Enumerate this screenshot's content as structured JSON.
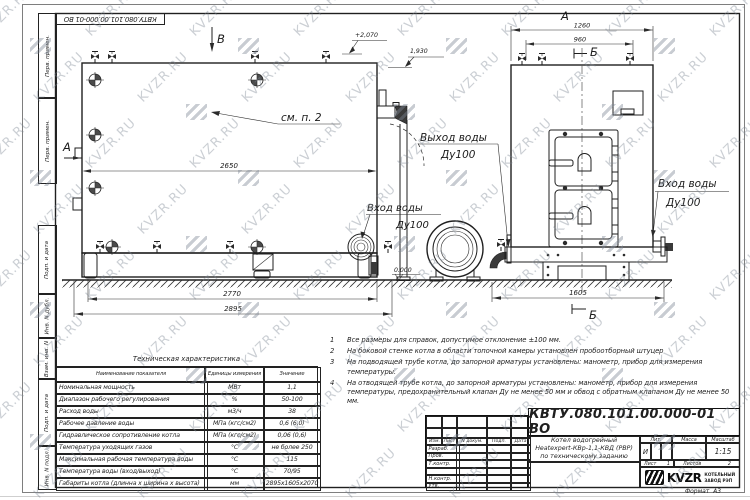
{
  "watermark": {
    "text": "KVZR.RU"
  },
  "corner_stamp": {
    "doc_number": "КВТУ.080.101.00.000-01 ВО"
  },
  "side_strip": {
    "labels": [
      "Перв. примен.",
      "Перв. примен.",
      "Подп. и дата",
      "Инв. N дубл.",
      "Взам. инв. N",
      "Подп. и дата",
      "Инв. N подл."
    ]
  },
  "views": {
    "left": {
      "label_a": "А",
      "label_b": "В",
      "see_note": "см. п. 2",
      "outlet_label": "Выход воды",
      "outlet_dn": "Ду100",
      "inlet_label": "Вход воды",
      "inlet_dn": "Ду100",
      "dim_2650": "2650",
      "dim_2770": "2770",
      "dim_2895": "2895",
      "elev_top": "+2,070",
      "elev_mid": "1,930",
      "elev_zero": "0.000"
    },
    "front": {
      "label_a": "А",
      "sec_b_top": "Б",
      "sec_b_bottom": "Б",
      "inlet_label": "Вход воды",
      "inlet_dn": "Ду100",
      "dim_1260": "1260",
      "dim_960": "960",
      "dim_1605": "1605"
    }
  },
  "notes": [
    {
      "num": "1",
      "text": "Все размеры для справок, допустимое отклонение ±100 мм."
    },
    {
      "num": "2",
      "text": "На боковой стенке котла в области топочной камеры установлен пробоотборный штуцер"
    },
    {
      "num": "3",
      "text": "На  подводящей трубе котла, до запорной арматуры установлены: манометр, прибор для измерения температуры."
    },
    {
      "num": "4",
      "text": "На отводящей трубе котла, до запорной арматуры установлены: манометр, прибор для измерения температуры, предохранительный клапан Ду не менее 50 мм и обвод с обратным клапаном Ду не менее 50 мм."
    }
  ],
  "spec_table": {
    "title": "Техническая характеристика",
    "headers": [
      "Наименование показателя",
      "Единицы измерения",
      "Значение"
    ],
    "rows": [
      [
        "Номинальная мощность",
        "МВт",
        "1,1"
      ],
      [
        "Диапазон рабочего регулирования",
        "%",
        "50-100"
      ],
      [
        "Расход воды",
        "м3/ч",
        "38"
      ],
      [
        "Рабочее давление воды",
        "МПа (кгс/см2)",
        "0,6 (6,0)"
      ],
      [
        "Гидравлическое сопротивление котла",
        "МПа (кгс/см2)",
        "0,06 (0,6)"
      ],
      [
        "Температура уходящих газов",
        "°С",
        "не более 250"
      ],
      [
        "Максимальная рабочая температура воды",
        "°С",
        "115"
      ],
      [
        "Температура воды (вход/выход)",
        "°С",
        "70/95"
      ],
      [
        "Габариты котла (длинна х ширина х высота)",
        "мм",
        "2895х1605х2070"
      ]
    ]
  },
  "title_block": {
    "doc_number": "КВТУ.080.101.00.000-01 ВО",
    "header_cells": [
      "Изм.",
      "Лист",
      "N докум.",
      "Подп.",
      "Дата"
    ],
    "left_rows": [
      "Разраб.",
      "Пров.",
      "Т.контр.",
      "",
      "Н.контр.",
      "Утв."
    ],
    "name_line1": "Котел водогрейный",
    "name_line2": "Heatexpert-КВр-1,1-КВД (РВР)",
    "name_line3": "по техническому заданию",
    "lit_label": "Лит.",
    "lit_value": "И",
    "mass_label": "Масса",
    "scale_label": "Масштаб",
    "scale_value": "1:15",
    "sheet_label": "Лист",
    "sheet_value": "1",
    "sheets_label": "Листов",
    "sheets_value": "2",
    "logo_word": "KVZR",
    "company_line1": "КОТЕЛЬНЫЙ",
    "company_line2": "ЗАВОД РЭП",
    "format_label": "Формат",
    "format_value": "А3"
  }
}
